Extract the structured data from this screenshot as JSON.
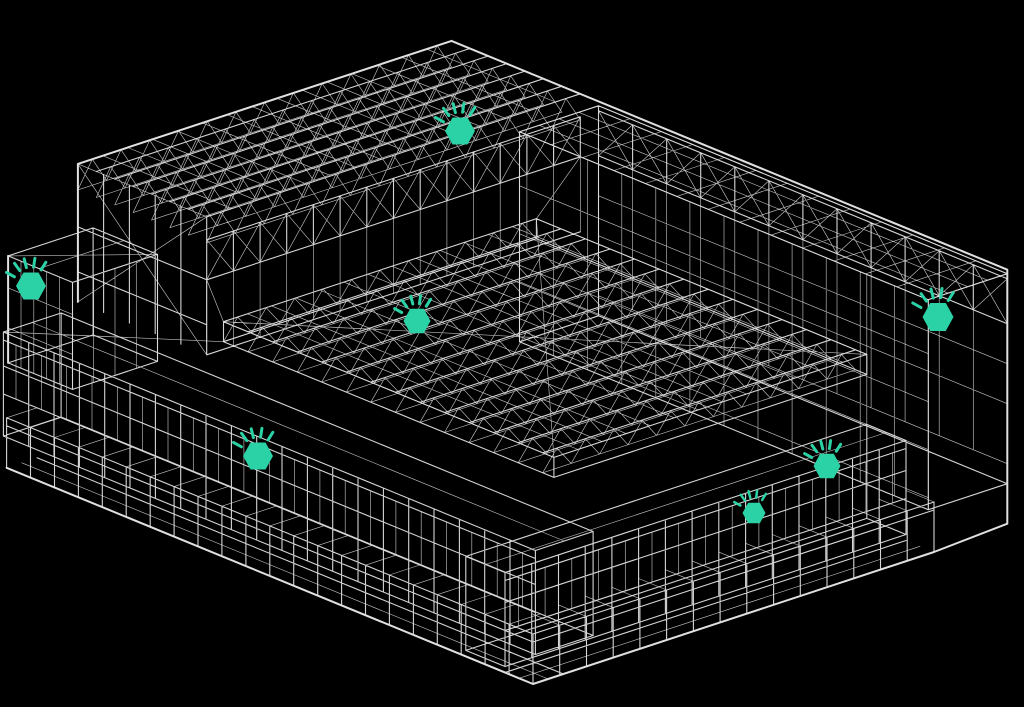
{
  "viewport": {
    "width": 1024,
    "height": 707,
    "background_color": "#000000"
  },
  "model": {
    "kind": "building-wireframe-3d",
    "wireframe_color": "#e0e0e0"
  },
  "markers": {
    "color": "#2bd2a6",
    "shape": "hexagon-with-pulse-rays",
    "count": 7,
    "items": [
      {
        "id": "sensor-1",
        "x": 460,
        "y": 131,
        "size": 30
      },
      {
        "id": "sensor-2",
        "x": 31,
        "y": 286,
        "size": 30
      },
      {
        "id": "sensor-3",
        "x": 417,
        "y": 321,
        "size": 27
      },
      {
        "id": "sensor-4",
        "x": 938,
        "y": 317,
        "size": 31
      },
      {
        "id": "sensor-5",
        "x": 258,
        "y": 456,
        "size": 30
      },
      {
        "id": "sensor-6",
        "x": 827,
        "y": 466,
        "size": 27
      },
      {
        "id": "sensor-7",
        "x": 754,
        "y": 513,
        "size": 23
      }
    ]
  }
}
